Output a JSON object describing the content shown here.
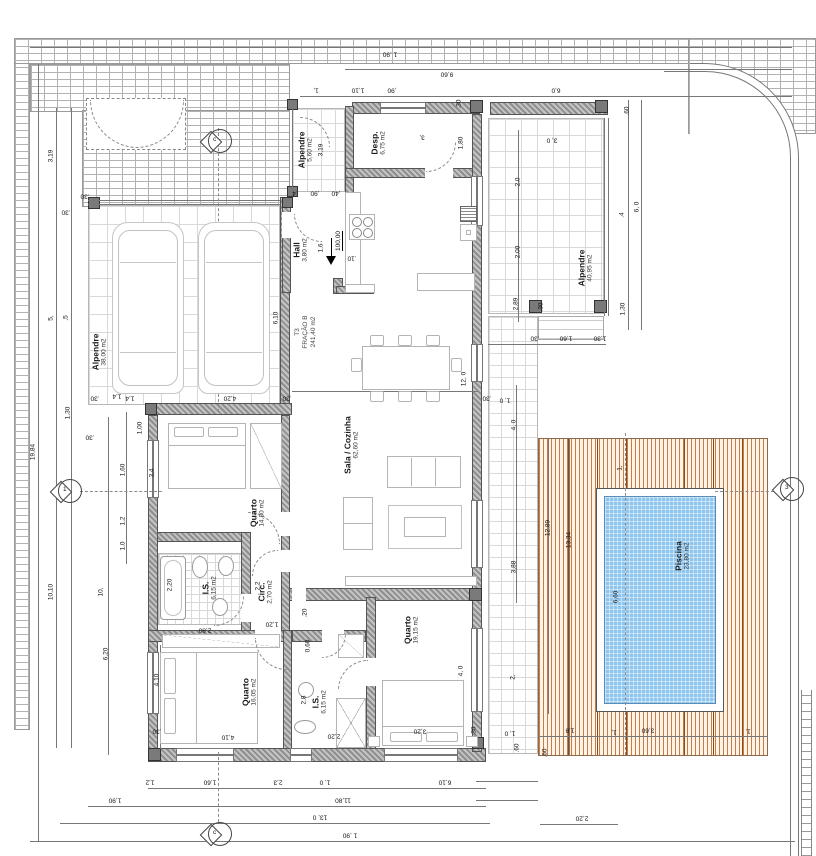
{
  "fraction": {
    "line1": "T3",
    "line2": "FRAÇÃO B",
    "line3": "241,40 m2",
    "x": 306,
    "y": 332
  },
  "level": {
    "value": "100,00",
    "x": 339,
    "y": 241
  },
  "rooms": [
    {
      "name": "Alpendre",
      "area": "38,00 m2",
      "x": 100,
      "y": 352
    },
    {
      "name": "Alpendre",
      "area": "5,60 m2",
      "x": 306,
      "y": 150
    },
    {
      "name": "Desp.",
      "area": "6,75 m2",
      "x": 379,
      "y": 143
    },
    {
      "name": "Hall",
      "area": "3,80 m2",
      "x": 301,
      "y": 250
    },
    {
      "name": "Sala / Cozinha",
      "area": "62,60 m2",
      "x": 352,
      "y": 445
    },
    {
      "name": "Quarto",
      "area": "14,80 m2",
      "x": 258,
      "y": 513
    },
    {
      "name": "I.S.",
      "area": "6,15 m2",
      "x": 210,
      "y": 588
    },
    {
      "name": "Circ.",
      "area": "2,70 m2",
      "x": 266,
      "y": 592
    },
    {
      "name": "Quarto",
      "area": "16,05 m2",
      "x": 250,
      "y": 692
    },
    {
      "name": "I.S.",
      "area": "6,15 m2",
      "x": 320,
      "y": 702
    },
    {
      "name": "Quarto",
      "area": "19,15 m2",
      "x": 412,
      "y": 630
    },
    {
      "name": "Alpendre",
      "area": "40,95 m2",
      "x": 586,
      "y": 268
    },
    {
      "name": "Piscina",
      "area": "23,80 m2",
      "x": 683,
      "y": 556
    }
  ],
  "markers": [
    {
      "letter": "c",
      "x": 218,
      "y": 142
    },
    {
      "letter": "1",
      "x": 68,
      "y": 492
    },
    {
      "letter": "c",
      "x": 218,
      "y": 835
    },
    {
      "letter": "3",
      "x": 790,
      "y": 490
    }
  ],
  "dims": [
    {
      "t": "1 ,90",
      "x": 390,
      "y": 54,
      "r": 180
    },
    {
      "t": "9,60",
      "x": 447,
      "y": 74,
      "r": 180
    },
    {
      "t": "1,",
      "x": 316,
      "y": 90,
      "r": 180
    },
    {
      "t": "1,10",
      "x": 358,
      "y": 90,
      "r": 180
    },
    {
      "t": ",90",
      "x": 392,
      "y": 90,
      "r": 180
    },
    {
      "t": "6,0",
      "x": 556,
      "y": 90,
      "r": 180
    },
    {
      "t": ".30",
      "x": 459,
      "y": 104,
      "r": 90
    },
    {
      "t": ".60",
      "x": 627,
      "y": 111,
      "r": 90
    },
    {
      "t": "19,84",
      "x": 33,
      "y": 452,
      "r": 90
    },
    {
      "t": "3,19",
      "x": 51,
      "y": 156,
      "r": 90
    },
    {
      "t": "5,",
      "x": 51,
      "y": 318,
      "r": 90
    },
    {
      "t": ",5",
      "x": 66,
      "y": 318,
      "r": 90
    },
    {
      "t": ".30",
      "x": 66,
      "y": 212,
      "r": 180
    },
    {
      "t": "10,10",
      "x": 51,
      "y": 592,
      "r": 90
    },
    {
      "t": "1,30",
      "x": 68,
      "y": 413,
      "r": 90
    },
    {
      "t": ".30",
      "x": 90,
      "y": 437,
      "r": 180
    },
    {
      "t": "1,4",
      "x": 117,
      "y": 396,
      "r": 180
    },
    {
      "t": "1,00",
      "x": 140,
      "y": 428,
      "r": 90
    },
    {
      "t": "1,60",
      "x": 123,
      "y": 470,
      "r": 90
    },
    {
      "t": "1,2",
      "x": 123,
      "y": 521,
      "r": 90
    },
    {
      "t": "1,0",
      "x": 123,
      "y": 546,
      "r": 90
    },
    {
      "t": "10,",
      "x": 101,
      "y": 592,
      "r": 90
    },
    {
      "t": "6,20",
      "x": 106,
      "y": 654,
      "r": 90
    },
    {
      "t": "3,4",
      "x": 152,
      "y": 473,
      "r": 90
    },
    {
      "t": "4,10",
      "x": 157,
      "y": 680,
      "r": 90
    },
    {
      "t": ".30",
      "x": 85,
      "y": 196,
      "r": 180
    },
    {
      "t": ".30",
      "x": 95,
      "y": 398,
      "r": 180
    },
    {
      "t": "1,4",
      "x": 130,
      "y": 398,
      "r": 180
    },
    {
      "t": "4,20",
      "x": 230,
      "y": 398,
      "r": 180
    },
    {
      "t": ".30",
      "x": 287,
      "y": 398,
      "r": 180
    },
    {
      "t": "6,10",
      "x": 276,
      "y": 318,
      "r": 90
    },
    {
      "t": "3,19",
      "x": 321,
      "y": 150,
      "r": 90
    },
    {
      "t": ".4",
      "x": 295,
      "y": 193,
      "r": 180
    },
    {
      "t": ",90",
      "x": 315,
      "y": 193,
      "r": 180
    },
    {
      "t": ",40",
      "x": 336,
      "y": 193,
      "r": 180
    },
    {
      "t": "1,80",
      "x": 461,
      "y": 143,
      "r": 90
    },
    {
      "t": "3,",
      "x": 422,
      "y": 137,
      "r": 180
    },
    {
      "t": "1,6",
      "x": 321,
      "y": 248,
      "r": 90
    },
    {
      "t": ".10",
      "x": 352,
      "y": 258,
      "r": 180
    },
    {
      "t": "12, 0",
      "x": 464,
      "y": 379,
      "r": 90
    },
    {
      "t": ".30",
      "x": 487,
      "y": 398,
      "r": 180
    },
    {
      "t": "1, 0",
      "x": 505,
      "y": 400,
      "r": 180
    },
    {
      "t": "4, 0",
      "x": 514,
      "y": 425,
      "r": 90
    },
    {
      "t": "3,88",
      "x": 514,
      "y": 567,
      "r": 90
    },
    {
      "t": "2,0",
      "x": 518,
      "y": 182,
      "r": 90
    },
    {
      "t": "2,00",
      "x": 518,
      "y": 252,
      "r": 90
    },
    {
      "t": "2,89",
      "x": 516,
      "y": 304,
      "r": 90
    },
    {
      "t": "3, 0",
      "x": 552,
      "y": 140,
      "r": 180
    },
    {
      "t": ".30",
      "x": 541,
      "y": 307,
      "r": 90
    },
    {
      "t": "6, 0",
      "x": 637,
      "y": 207,
      "r": 90
    },
    {
      "t": ".4",
      "x": 622,
      "y": 215,
      "r": 90
    },
    {
      "t": "1,30",
      "x": 623,
      "y": 309,
      "r": 90
    },
    {
      "t": ".30",
      "x": 535,
      "y": 338,
      "r": 180
    },
    {
      "t": "1,60",
      "x": 566,
      "y": 338,
      "r": 180
    },
    {
      "t": "1,30",
      "x": 600,
      "y": 338,
      "r": 180
    },
    {
      "t": "12,89",
      "x": 548,
      "y": 528,
      "r": 90
    },
    {
      "t": "13,34",
      "x": 569,
      "y": 540,
      "r": 90
    },
    {
      "t": "6,60",
      "x": 616,
      "y": 597,
      "r": 90
    },
    {
      "t": "1,",
      "x": 620,
      "y": 468,
      "r": 90
    },
    {
      "t": "2,",
      "x": 513,
      "y": 677,
      "r": 90
    },
    {
      "t": "1, 0",
      "x": 510,
      "y": 733,
      "r": 180
    },
    {
      "t": ".60",
      "x": 517,
      "y": 748,
      "r": 90
    },
    {
      "t": ".60",
      "x": 545,
      "y": 753,
      "r": 90
    },
    {
      "t": "1,8",
      "x": 570,
      "y": 730,
      "r": 180
    },
    {
      "t": "1,",
      "x": 614,
      "y": 732,
      "r": 180
    },
    {
      "t": "3,60",
      "x": 648,
      "y": 730,
      "r": 180
    },
    {
      "t": "1,",
      "x": 748,
      "y": 731,
      "r": 180
    },
    {
      "t": "2,80",
      "x": 205,
      "y": 630,
      "r": 180
    },
    {
      "t": "1,20",
      "x": 272,
      "y": 624,
      "r": 180
    },
    {
      "t": ".20",
      "x": 305,
      "y": 613,
      "r": 90
    },
    {
      "t": "0,60",
      "x": 308,
      "y": 646,
      "r": 90
    },
    {
      "t": "2,8",
      "x": 304,
      "y": 700,
      "r": 90
    },
    {
      "t": "2,20",
      "x": 334,
      "y": 736,
      "r": 180
    },
    {
      "t": "4,10",
      "x": 228,
      "y": 737,
      "r": 180
    },
    {
      "t": ".30",
      "x": 157,
      "y": 731,
      "r": 180
    },
    {
      "t": "3,20",
      "x": 420,
      "y": 731,
      "r": 180
    },
    {
      "t": ".30",
      "x": 474,
      "y": 731,
      "r": 90
    },
    {
      "t": "4, 0",
      "x": 461,
      "y": 671,
      "r": 90
    },
    {
      "t": "2,2",
      "x": 258,
      "y": 586,
      "r": 90
    },
    {
      "t": "2,20",
      "x": 170,
      "y": 585,
      "r": 90
    },
    {
      "t": "1,2",
      "x": 150,
      "y": 782,
      "r": 180
    },
    {
      "t": "1,60",
      "x": 210,
      "y": 782,
      "r": 180
    },
    {
      "t": "2,3",
      "x": 278,
      "y": 782,
      "r": 180
    },
    {
      "t": "1, 0",
      "x": 325,
      "y": 782,
      "r": 180
    },
    {
      "t": "6,10",
      "x": 445,
      "y": 782,
      "r": 180
    },
    {
      "t": "1,90",
      "x": 115,
      "y": 800,
      "r": 180
    },
    {
      "t": "11,80",
      "x": 343,
      "y": 800,
      "r": 180
    },
    {
      "t": "13, 0",
      "x": 320,
      "y": 817,
      "r": 180
    },
    {
      "t": "1 ,90",
      "x": 350,
      "y": 835,
      "r": 180
    },
    {
      "t": "2,20",
      "x": 582,
      "y": 818,
      "r": 180
    }
  ],
  "colors": {
    "wall": "#8f8f8f",
    "pillar": "#7a7a7a",
    "water": "#8ec6ef",
    "deck_line": "#c97b44",
    "grid": "#d9d9d9"
  }
}
